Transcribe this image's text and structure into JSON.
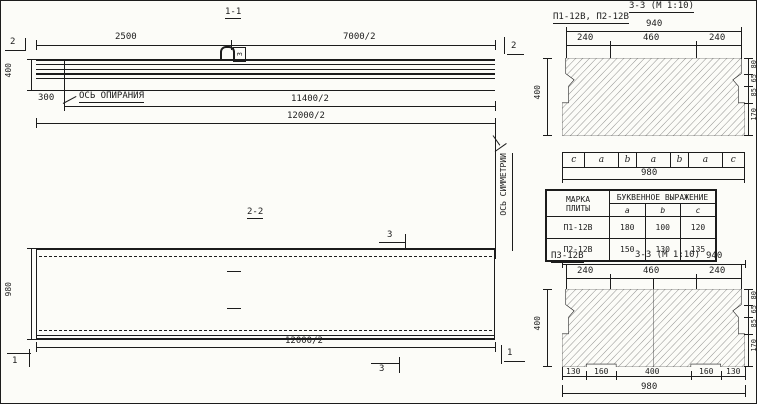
{
  "meta": {
    "ink": "#1c1c1c",
    "paper": "#fcfcf8"
  },
  "view11": {
    "title": "1-1",
    "cut_left": "2",
    "cut_right": "2",
    "dim_2500": "2500",
    "dim_7000": "7000/2",
    "dim_400": "400",
    "dim_300": "300",
    "support_axis": "ОСЬ ОПИРАНИЯ",
    "dim_11400": "11400/2",
    "dim_12000": "12000/2",
    "loop_mark": "3"
  },
  "axis": {
    "symmetry": "ОСЬ СИММЕТРИИ"
  },
  "view22": {
    "title": "2-2",
    "cut3_top": "3",
    "cut3_bottom": "3",
    "cut1_left": "1",
    "cut1_right": "1",
    "dim_980": "980",
    "dim_12000": "12000/2"
  },
  "s1": {
    "marks": "П1-12В, П2-12В",
    "title": "3-3 (М 1:10)",
    "top": "940",
    "segs": [
      "240",
      "460",
      "240"
    ],
    "h": "400",
    "rsegs": [
      "80",
      "65",
      "85",
      "170"
    ],
    "letters": [
      "c",
      "a",
      "b",
      "a",
      "b",
      "a",
      "c"
    ],
    "bottom": "980"
  },
  "table": {
    "h_mark1": "МАРКА",
    "h_mark2": "ПЛИТЫ",
    "h_expr": "БУКВЕННОЕ ВЫРАЖЕНИЕ",
    "cols": [
      "a",
      "b",
      "c"
    ],
    "rows": [
      {
        "mark": "П1-12В",
        "a": "180",
        "b": "100",
        "c": "120"
      },
      {
        "mark": "П2-12В",
        "a": "150",
        "b": "130",
        "c": "135"
      }
    ]
  },
  "s2": {
    "mark": "П3-12В",
    "title": "3-3 (М 1:10)",
    "top": "940",
    "segs": [
      "240",
      "460",
      "240"
    ],
    "h": "400",
    "rsegs": [
      "80",
      "65",
      "85",
      "170"
    ],
    "bsegs": [
      "130",
      "160",
      "400",
      "160",
      "130"
    ],
    "bottom": "980"
  }
}
